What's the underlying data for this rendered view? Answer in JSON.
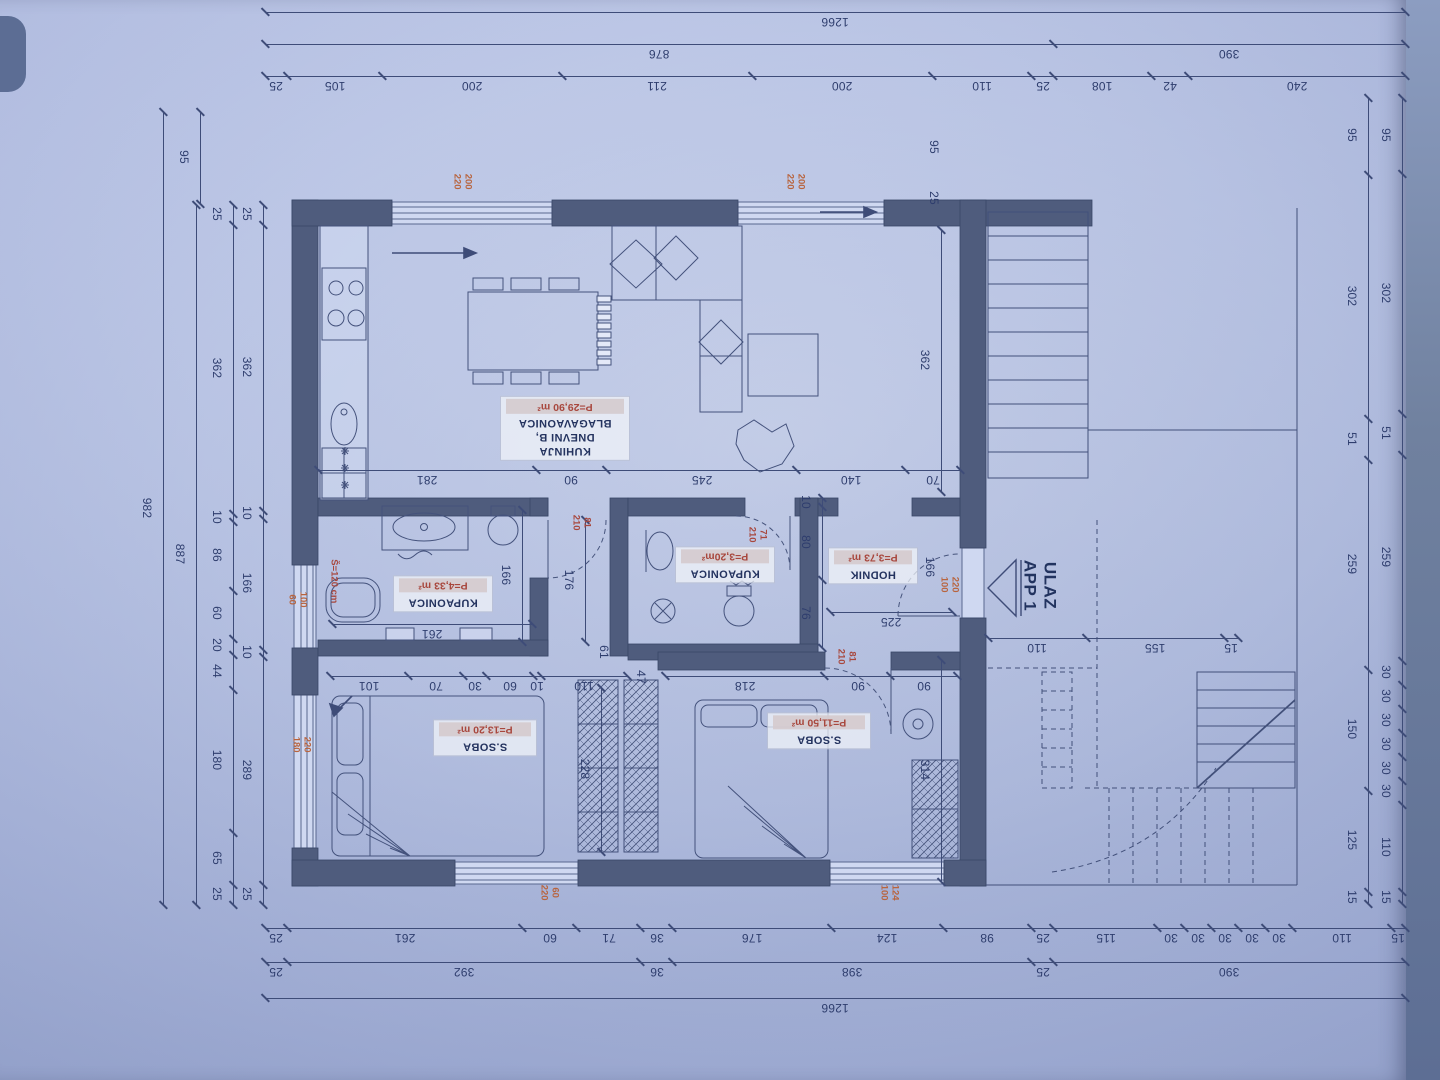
{
  "document": {
    "kind": "floor-plan blueprint photo, drawing appears rotated 180°"
  },
  "colors": {
    "paper": "#bcc7e8",
    "line": "#3e4c78",
    "wall": "#4f5c7d",
    "dim_text": "#2e3d6d",
    "red_accent": "#a8473d",
    "orange_accent": "#b8643e"
  },
  "entrance": {
    "line1": "ULAZ",
    "line2": "APP 1",
    "x": 1040,
    "y": 588
  },
  "rooms": [
    {
      "id": "living",
      "name_lines": [
        "KUHINJA",
        "DNEVNI B,",
        "BLAGAVAONICA"
      ],
      "area": "P=29,90 m²",
      "cx": 565,
      "cy": 428,
      "w": 118
    },
    {
      "id": "bath1",
      "name_lines": [
        "KUPAONICA"
      ],
      "area": "P=4,33 m²",
      "cx": 443,
      "cy": 593,
      "w": 88
    },
    {
      "id": "bath2",
      "name_lines": [
        "KUPAONICA"
      ],
      "area": "P=3,20m²",
      "cx": 725,
      "cy": 564,
      "w": 88
    },
    {
      "id": "hall",
      "name_lines": [
        "HODNIK"
      ],
      "area": "P=3,73 m²",
      "cx": 873,
      "cy": 565,
      "w": 78
    },
    {
      "id": "bedroom1",
      "name_lines": [
        "S.SOBA"
      ],
      "area": "P=13,20 m²",
      "cx": 485,
      "cy": 737,
      "w": 92
    },
    {
      "id": "bedroom2",
      "name_lines": [
        "S.SOBA"
      ],
      "area": "P=11,50 m²",
      "cx": 819,
      "cy": 730,
      "w": 92
    }
  ],
  "chains": [
    {
      "id": "top-total",
      "o": "h",
      "x": 265,
      "y": 12,
      "len": 1140,
      "side": 1,
      "segs": [
        1266
      ]
    },
    {
      "id": "top-halves",
      "o": "h",
      "x": 265,
      "y": 44,
      "len": 1140,
      "side": 1,
      "segs": [
        876,
        390
      ]
    },
    {
      "id": "top-detail",
      "o": "h",
      "x": 265,
      "y": 76,
      "len": 1140,
      "side": 1,
      "segs": [
        25,
        105,
        200,
        211,
        200,
        110,
        25,
        108,
        42,
        240
      ]
    },
    {
      "id": "bottom-detail",
      "o": "h",
      "x": 265,
      "y": 928,
      "len": 1140,
      "side": 1,
      "segs": [
        25,
        261,
        60,
        71,
        36,
        176,
        124,
        98,
        25,
        115,
        30,
        30,
        30,
        30,
        30,
        110,
        15
      ]
    },
    {
      "id": "bottom-mid",
      "o": "h",
      "x": 265,
      "y": 962,
      "len": 1140,
      "side": 1,
      "segs": [
        25,
        392,
        36,
        398,
        25,
        390
      ]
    },
    {
      "id": "bottom-total",
      "o": "h",
      "x": 265,
      "y": 998,
      "len": 1140,
      "side": 1,
      "segs": [
        1266
      ]
    },
    {
      "id": "right-inner",
      "o": "v",
      "x": 1368,
      "y": 98,
      "len": 806,
      "side": -1,
      "segs": [
        95,
        302,
        51,
        259,
        150,
        125,
        15
      ]
    },
    {
      "id": "right-outer",
      "o": "v",
      "x": 1402,
      "y": 98,
      "len": 806,
      "side": -1,
      "segs": [
        95,
        302,
        51,
        259,
        30,
        30,
        30,
        30,
        30,
        30,
        110,
        15
      ]
    },
    {
      "id": "left-95",
      "o": "v",
      "x": 200,
      "y": 112,
      "len": 92,
      "side": -1,
      "segs": [
        95
      ]
    },
    {
      "id": "left-detail",
      "o": "v",
      "x": 233,
      "y": 205,
      "len": 700,
      "side": -1,
      "segs": [
        25,
        362,
        10,
        86,
        60,
        20,
        44,
        180,
        65,
        25
      ]
    },
    {
      "id": "left-inner",
      "o": "v",
      "x": 263,
      "y": 205,
      "len": 700,
      "side": -1,
      "segs": [
        25,
        362,
        10,
        166,
        10,
        289,
        25
      ]
    },
    {
      "id": "left-887",
      "o": "v",
      "x": 196,
      "y": 205,
      "len": 700,
      "side": -1,
      "segs": [
        887
      ]
    },
    {
      "id": "left-982",
      "o": "v",
      "x": 163,
      "y": 112,
      "len": 793,
      "side": -1,
      "segs": [
        982
      ]
    },
    {
      "id": "living-width",
      "o": "h",
      "x": 318,
      "y": 470,
      "len": 642,
      "side": 1,
      "segs": [
        281,
        90,
        245,
        140,
        70
      ]
    },
    {
      "id": "living-depth",
      "o": "v",
      "x": 941,
      "y": 230,
      "len": 262,
      "side": -1,
      "segs": [
        362
      ]
    },
    {
      "id": "bedroom1-top",
      "o": "h",
      "x": 330,
      "y": 676,
      "len": 297,
      "side": 1,
      "segs": [
        101,
        70,
        30,
        60,
        10,
        110
      ]
    },
    {
      "id": "bedroom2-top",
      "o": "h",
      "x": 665,
      "y": 676,
      "len": 292,
      "side": 1,
      "segs": [
        218,
        90,
        90
      ]
    },
    {
      "id": "bath1-width",
      "o": "h",
      "x": 332,
      "y": 624,
      "len": 200,
      "side": 1,
      "segs": [
        261
      ]
    },
    {
      "id": "bath1-depth",
      "o": "v",
      "x": 522,
      "y": 510,
      "len": 132,
      "side": -1,
      "segs": [
        166
      ]
    },
    {
      "id": "corridor-len",
      "o": "v",
      "x": 585,
      "y": 520,
      "len": 122,
      "side": -1,
      "segs": [
        176
      ]
    },
    {
      "id": "wardrobe-len",
      "o": "v",
      "x": 601,
      "y": 688,
      "len": 164,
      "side": -1,
      "segs": [
        228
      ]
    },
    {
      "id": "bedroom2-depth",
      "o": "v",
      "x": 941,
      "y": 660,
      "len": 222,
      "side": -1,
      "segs": [
        314
      ]
    },
    {
      "id": "hall-wall",
      "o": "v",
      "x": 822,
      "y": 498,
      "len": 150,
      "side": -1,
      "segs": [
        10,
        80,
        76
      ]
    },
    {
      "id": "hall-width",
      "o": "h",
      "x": 830,
      "y": 612,
      "len": 122,
      "side": 1,
      "segs": [
        225
      ]
    },
    {
      "id": "terrace",
      "o": "h",
      "x": 988,
      "y": 638,
      "len": 250,
      "side": 1,
      "segs": [
        110,
        155,
        15
      ]
    }
  ],
  "dims": [
    {
      "text": "61",
      "x": 604,
      "y": 653
    },
    {
      "text": "47",
      "x": 641,
      "y": 678
    },
    {
      "text": "95",
      "x": 934,
      "y": 148
    },
    {
      "text": "25",
      "x": 934,
      "y": 199
    },
    {
      "text": "166",
      "x": 930,
      "y": 568
    }
  ],
  "marks": [
    {
      "text": "200\n220",
      "x": 462,
      "y": 183,
      "tone": "orange"
    },
    {
      "text": "200\n220",
      "x": 795,
      "y": 183,
      "tone": "orange"
    },
    {
      "text": "81\n210",
      "x": 581,
      "y": 524,
      "tone": "red"
    },
    {
      "text": "71\n210",
      "x": 757,
      "y": 536,
      "tone": "red"
    },
    {
      "text": "220\n100",
      "x": 949,
      "y": 586,
      "tone": "orange"
    },
    {
      "text": "81\n210",
      "x": 846,
      "y": 658,
      "tone": "red"
    },
    {
      "text": "100\n60",
      "x": 297,
      "y": 601,
      "tone": "orange"
    },
    {
      "text": "220\n180",
      "x": 301,
      "y": 746,
      "tone": "orange"
    },
    {
      "text": "60\n220",
      "x": 549,
      "y": 894,
      "tone": "orange"
    },
    {
      "text": "124\n100",
      "x": 889,
      "y": 894,
      "tone": "orange"
    },
    {
      "text": "Š=120 cm",
      "x": 333,
      "y": 588,
      "tone": "red"
    }
  ]
}
